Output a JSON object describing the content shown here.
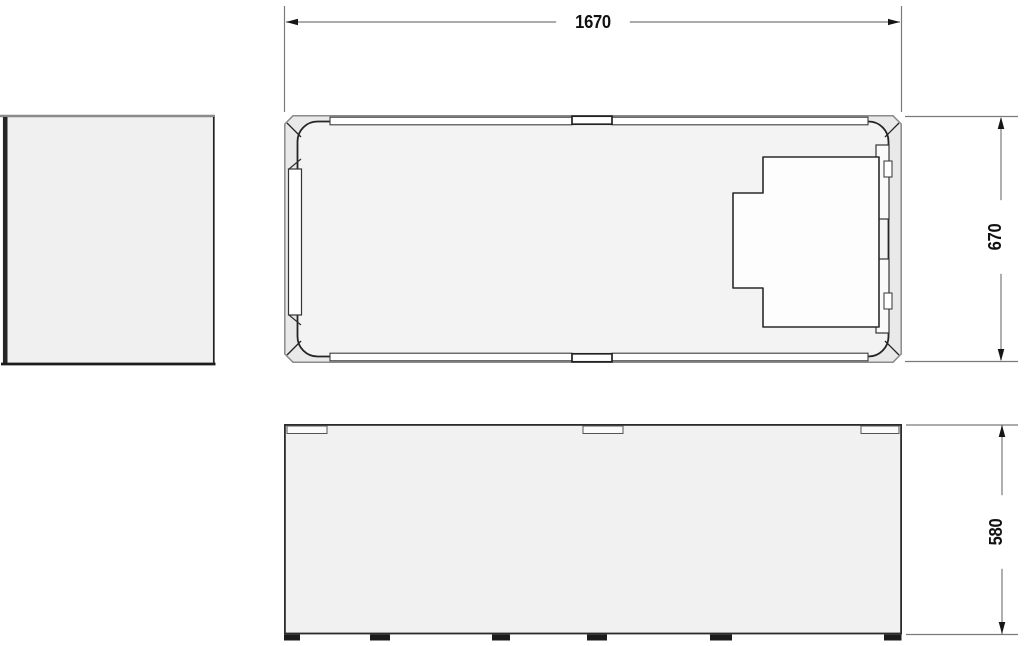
{
  "drawing": {
    "type": "technical-drawing",
    "labels": {
      "overall_width": "1670",
      "overall_depth": "670",
      "front_height": "580"
    },
    "colors": {
      "background": "#ffffff",
      "line_dark": "#242424",
      "line_gray": "#8a8a8a",
      "dimension_gray": "#7a7a7a",
      "text": "#111111",
      "view_fill": "#f0f0f0",
      "rim_band_fill": "#e9e9e9",
      "tub_floor_fill": "#f3f3f3",
      "detail_white": "#fdfdfd"
    }
  }
}
